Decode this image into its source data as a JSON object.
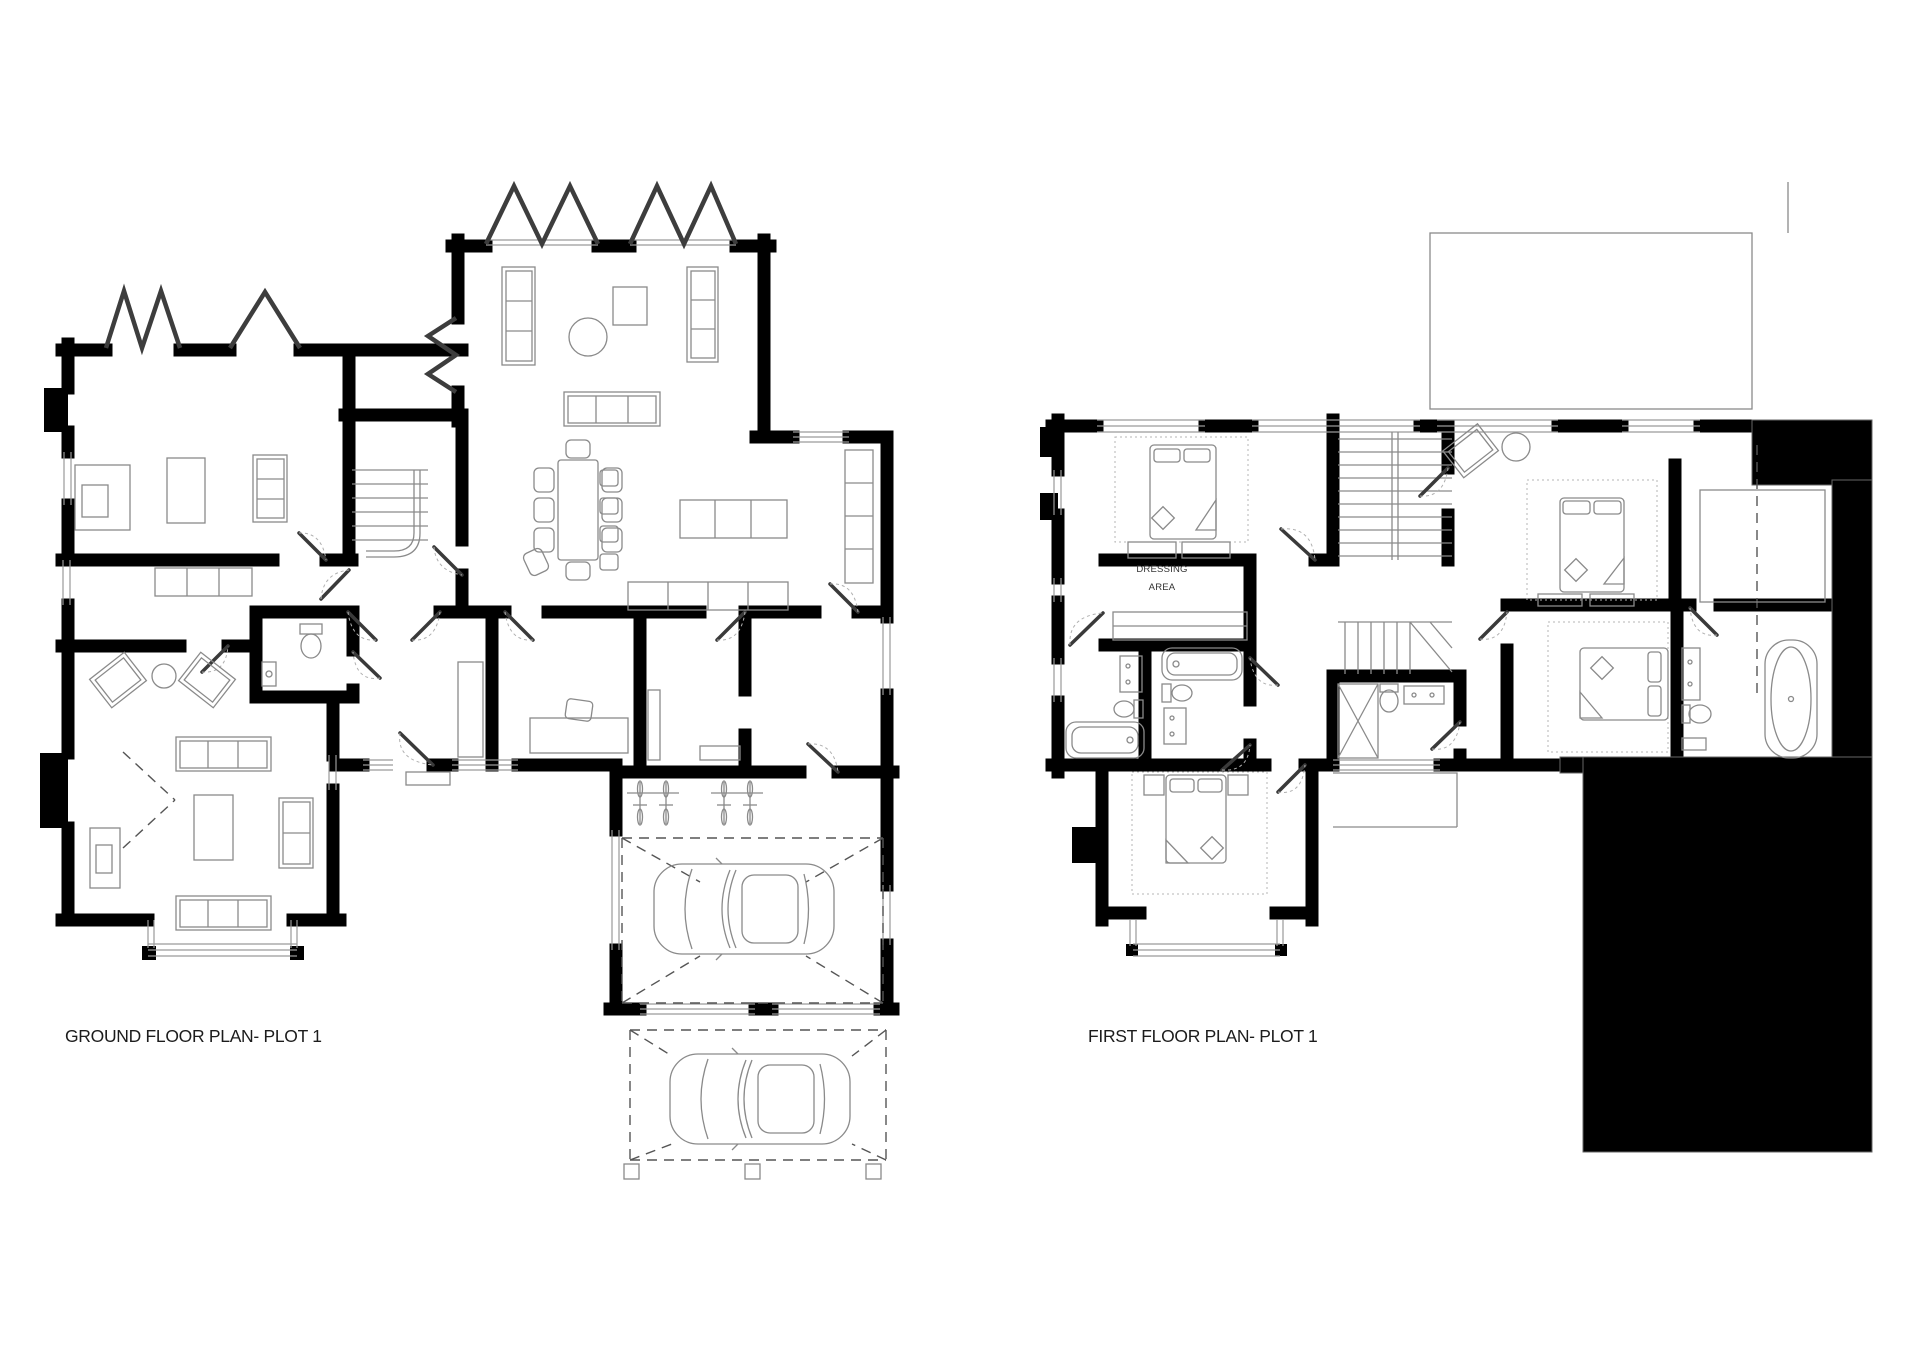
{
  "labels": {
    "ground_floor": "GROUND FLOOR PLAN- PLOT 1",
    "first_floor": "FIRST FLOOR PLAN- PLOT 1"
  },
  "annotations": {
    "dressing_area_line1": "DRESSING",
    "dressing_area_line2": "AREA"
  },
  "colors": {
    "wall": "#000000",
    "line": "#8a8a8a",
    "glz": "#9a9a9a",
    "door": "#3a3a3a",
    "dash": "#555555",
    "dot": "#b5b5b5",
    "paper": "#ffffff",
    "label": "#1c1c1c"
  }
}
